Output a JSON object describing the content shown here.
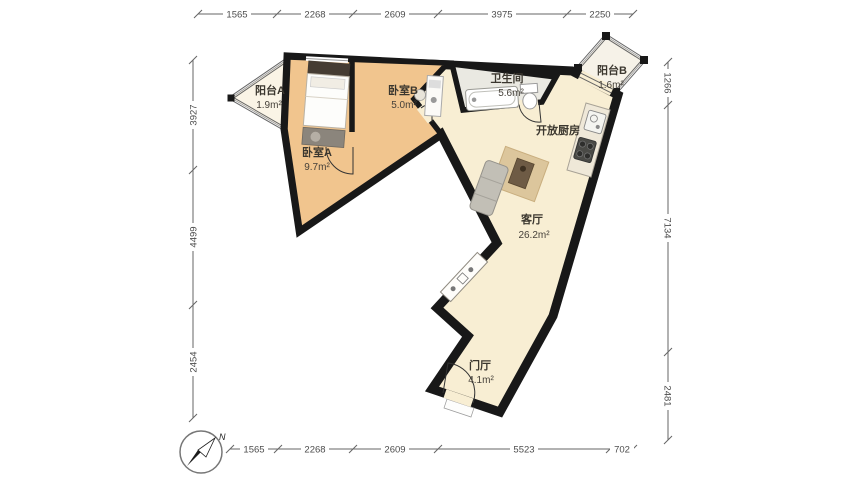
{
  "rooms": [
    {
      "id": "balcony-a",
      "name": "阳台A",
      "area": "1.9m²"
    },
    {
      "id": "bedroom-a",
      "name": "卧室A",
      "area": "9.7m²"
    },
    {
      "id": "bedroom-b",
      "name": "卧室B",
      "area": "5.0m²"
    },
    {
      "id": "bathroom",
      "name": "卫生间",
      "area": "5.6m²"
    },
    {
      "id": "balcony-b",
      "name": "阳台B",
      "area": "1.6m²"
    },
    {
      "id": "kitchen",
      "name": "开放厨房",
      "area": ""
    },
    {
      "id": "living",
      "name": "客厅",
      "area": "26.2m²"
    },
    {
      "id": "foyer",
      "name": "门厅",
      "area": "4.1m²"
    }
  ],
  "dimensions": {
    "top": [
      "1565",
      "2268",
      "2609",
      "3975",
      "2250"
    ],
    "bottom": [
      "1565",
      "2268",
      "2609",
      "5523",
      "702"
    ],
    "left": [
      "3927",
      "4499",
      "2454"
    ],
    "right": [
      "1266",
      "7134",
      "2481"
    ]
  },
  "compass": {
    "north_label": "N"
  },
  "colors": {
    "wall": "#181818",
    "bedroom_fill": "#f1c58e",
    "living_fill": "#f8eed3",
    "bathroom_fill": "#eae9e2",
    "balcony_fill": "#f7f2e6",
    "dimension_line": "#666666"
  }
}
